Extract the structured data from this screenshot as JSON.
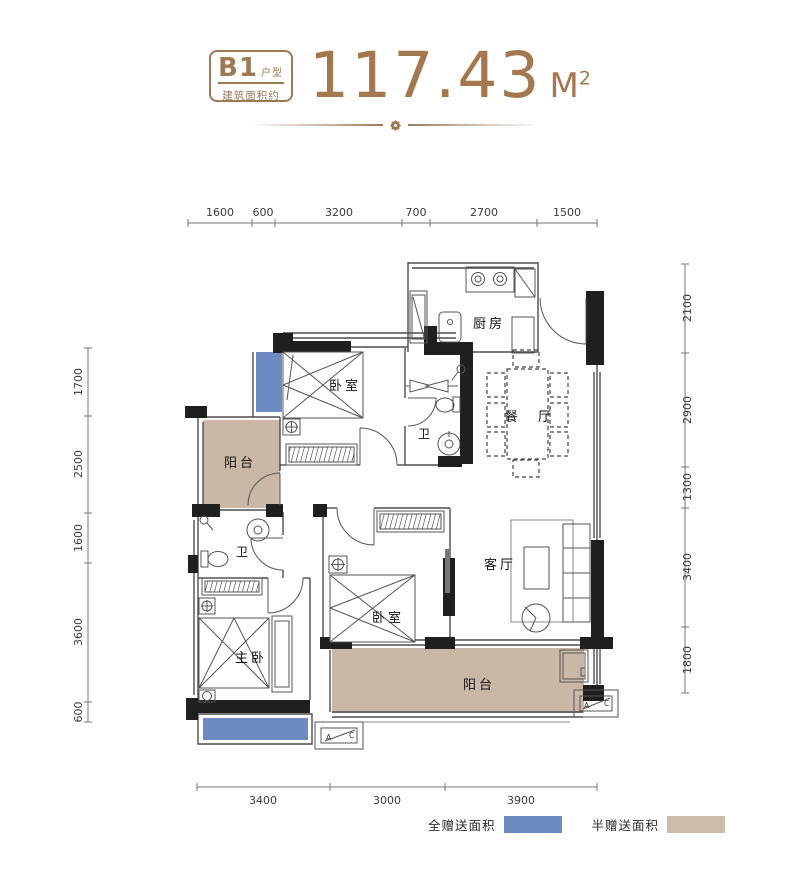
{
  "header": {
    "code": "B1",
    "code_suffix": "户型",
    "subtitle": "建筑面积约",
    "area": "117.43",
    "unit": "M",
    "unit_sup": "2"
  },
  "rooms": {
    "bedroom_top": "卧室",
    "bath_top": "卫",
    "kitchen": "厨房",
    "dining": "餐 厅",
    "balcony_left": "阳台",
    "bath_bottom": "卫",
    "master_bedroom": "主卧",
    "bedroom_bottom": "卧室",
    "living": "客厅",
    "balcony_bottom": "阳台"
  },
  "dims": {
    "top": [
      "1600",
      "600",
      "3200",
      "700",
      "2700",
      "1500"
    ],
    "bottom": [
      "3400",
      "3000",
      "3900"
    ],
    "left": [
      "1700",
      "2500",
      "1600",
      "3600",
      "600"
    ],
    "right": [
      "2100",
      "2900",
      "1300",
      "3400",
      "1800"
    ]
  },
  "ac": {
    "a": "A",
    "c": "C"
  },
  "legend": {
    "full": "全赠送面积",
    "half": "半赠送面积"
  },
  "colors": {
    "brand_brown": "#9c7a55",
    "area_number": "#a3784e",
    "gift_full_blue": "#6c8cc1",
    "gift_half_tan": "#cbb7a5",
    "legend_tan": "#cfbcab",
    "wall_black": "#1f1f1f"
  }
}
